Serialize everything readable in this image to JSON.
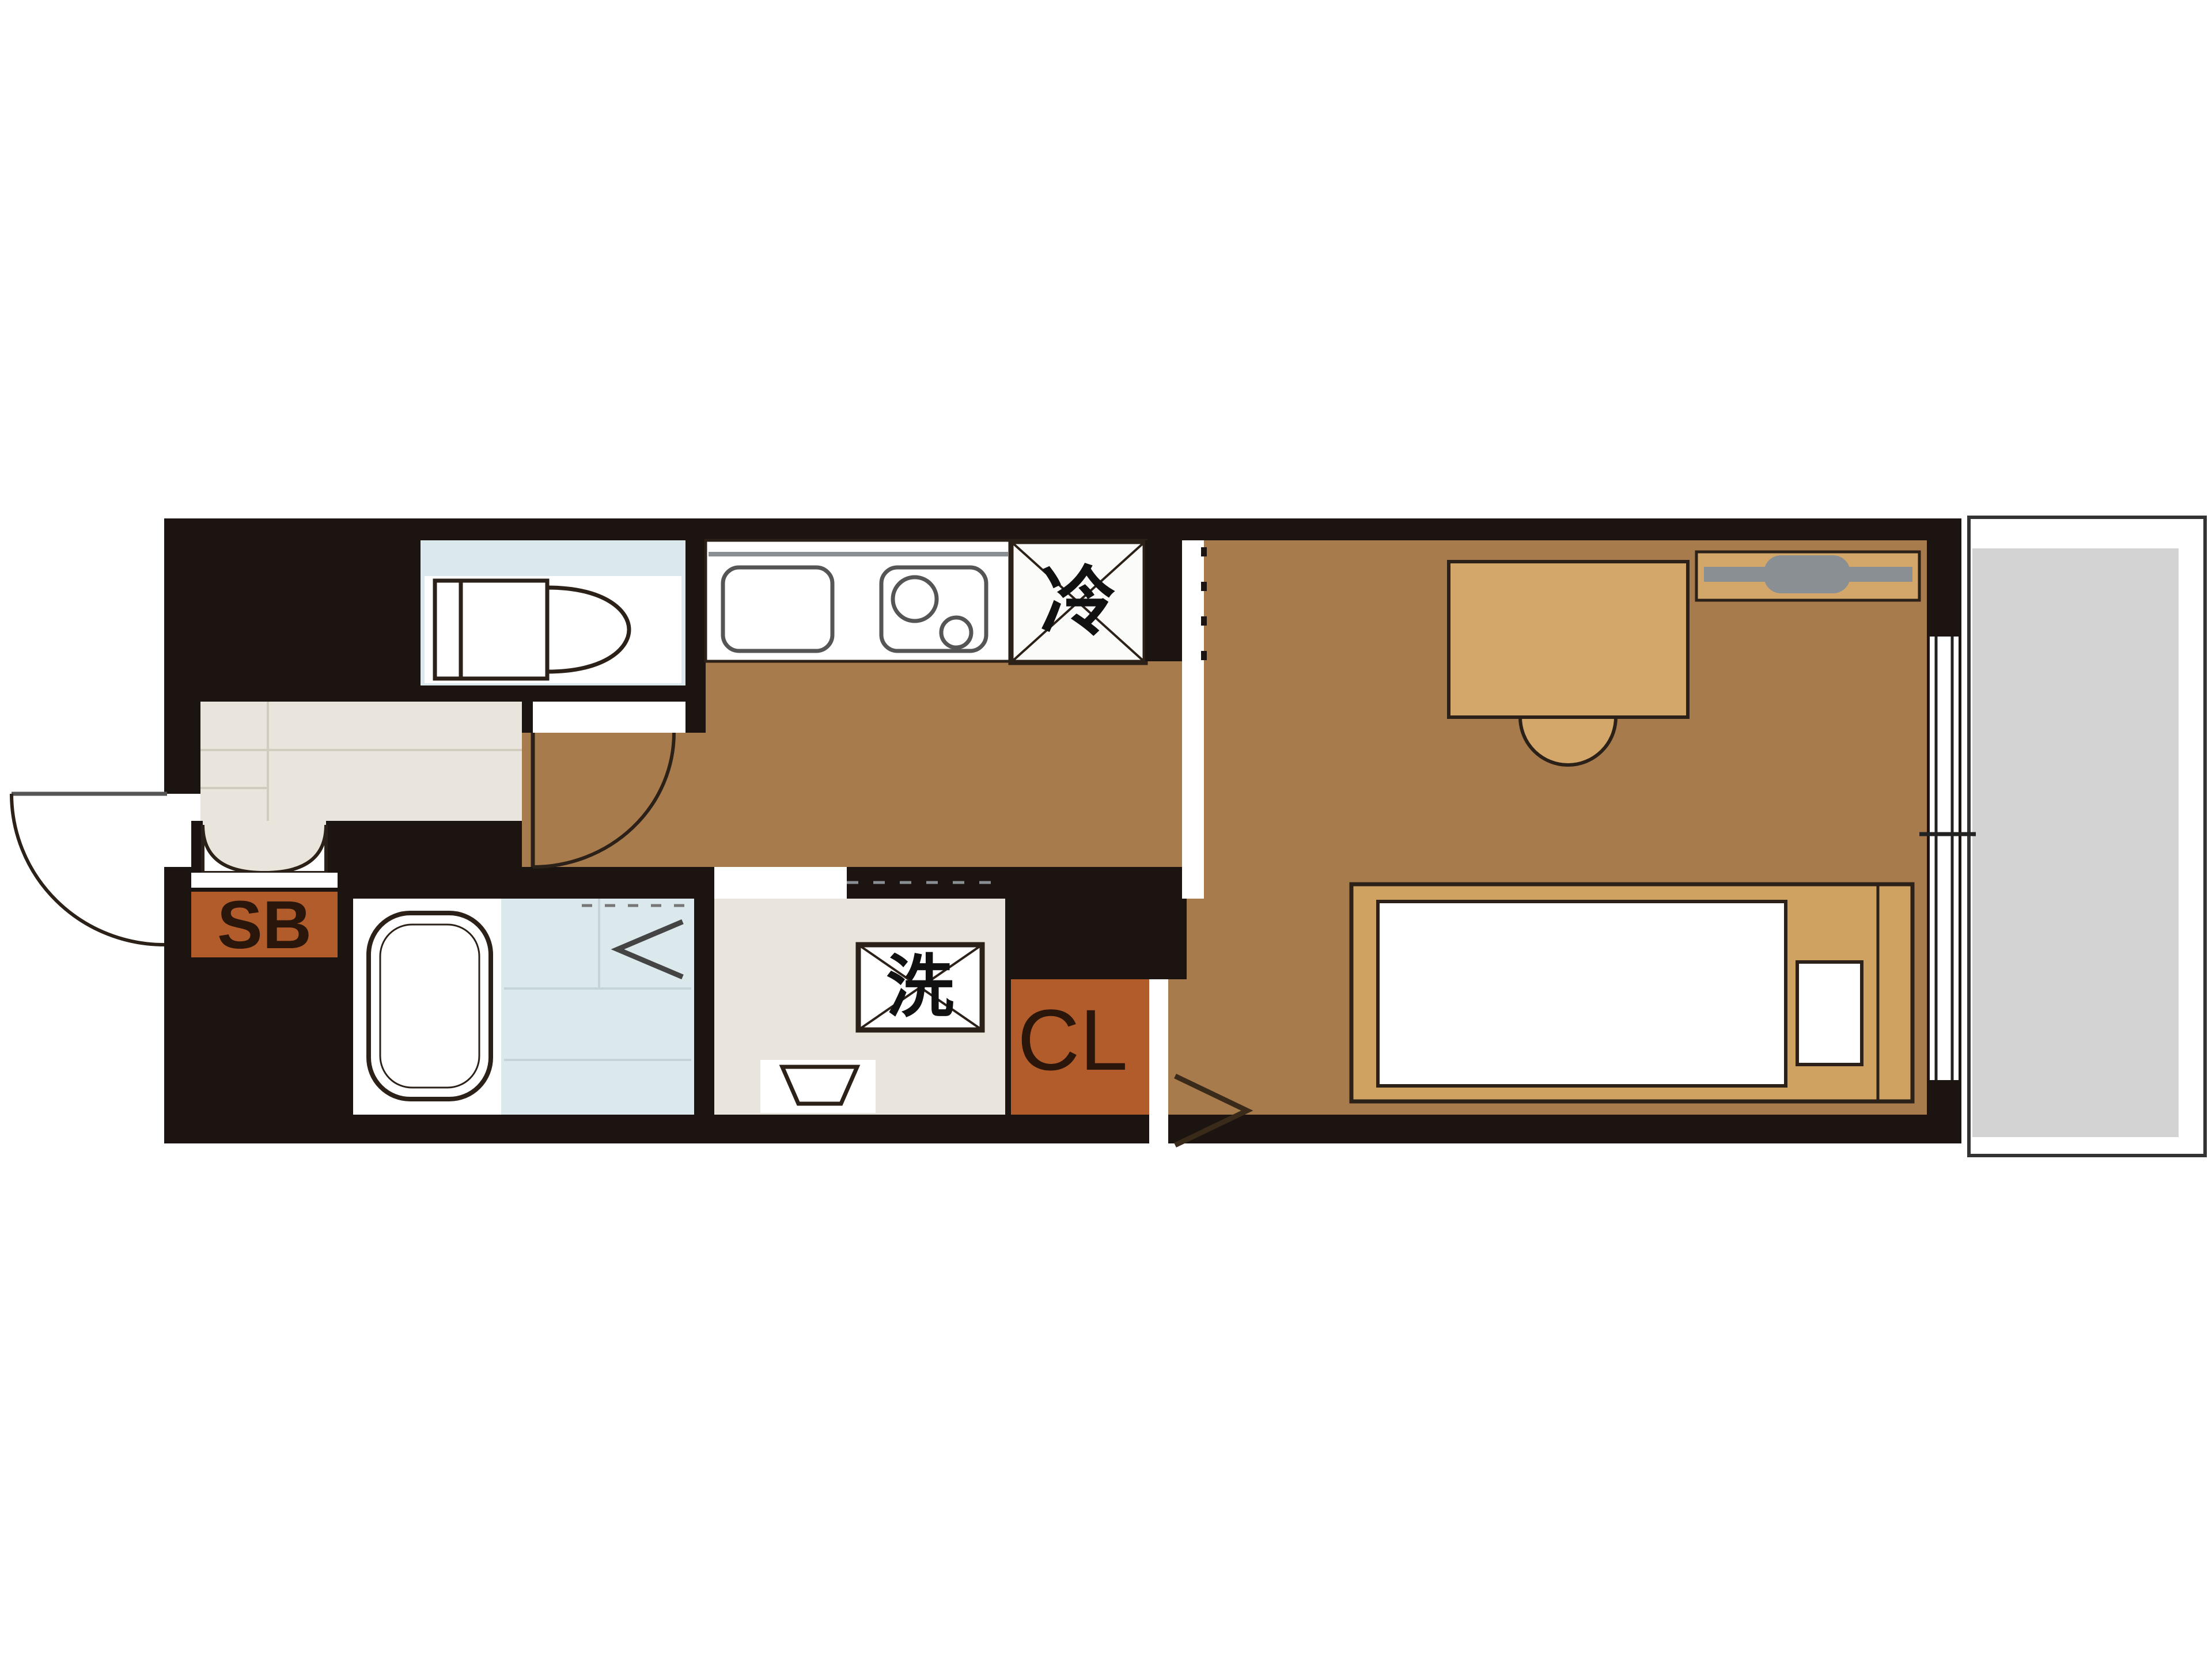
{
  "labels": {
    "shoe_box": "SB",
    "closet": "CL",
    "refrigerator": "冷",
    "washing_machine": "洗"
  },
  "colors": {
    "wall": "#1c1410",
    "floor": "#a87b4d",
    "furniture": "#d3a76a",
    "bed_frame": "#cfa262",
    "accent_orange": "#b25c2c",
    "wet_blue": "#dce9ec",
    "genkan_beige": "#e9e5dc",
    "balcony_gray": "#d3d3d3",
    "fixture_white": "#ffffff",
    "outline": "#2b2118",
    "metal_gray": "#8a8f94",
    "label_dark": "#2f1d10"
  }
}
